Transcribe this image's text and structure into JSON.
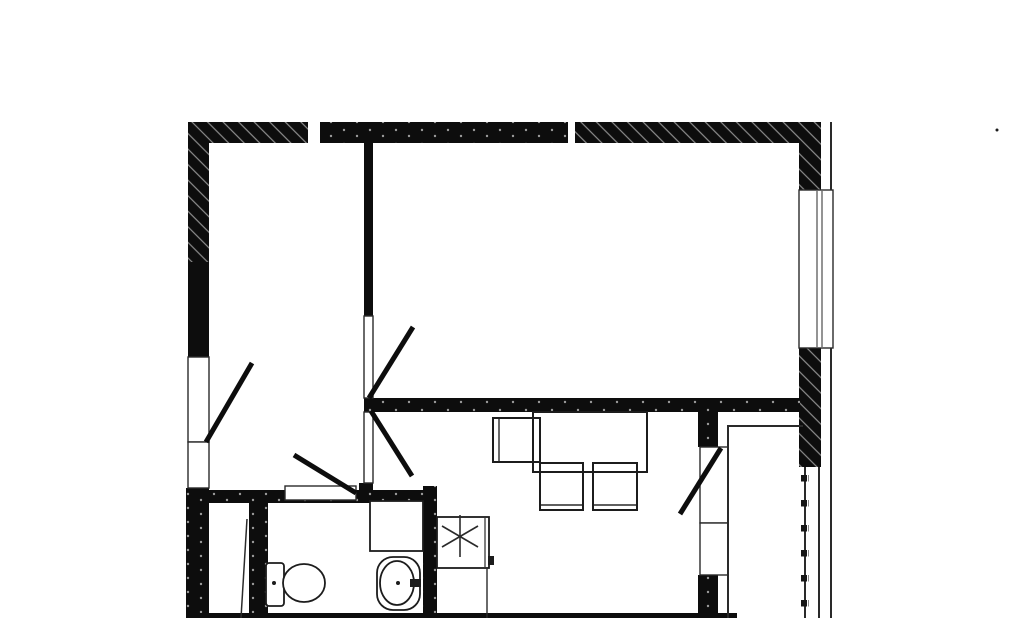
{
  "canvas": {
    "width": 1024,
    "height": 618,
    "background": "#ffffff"
  },
  "palette": {
    "wall": "#0d0d0d",
    "line": "#2a2a2a",
    "fixture": "#1c1c1c",
    "hatch_tick": "#8d8d8d",
    "dot": "#9a9a9a",
    "white": "#ffffff"
  },
  "plan": {
    "elements": [
      {
        "name": "top-wall-left-hatched",
        "kind": "rect",
        "style": "hatched",
        "x": 188,
        "y": 122,
        "w": 120,
        "h": 21
      },
      {
        "name": "top-wall-middle-dotted",
        "kind": "rect",
        "style": "dotted",
        "x": 320,
        "y": 122,
        "w": 248,
        "h": 21
      },
      {
        "name": "top-wall-right-hatched",
        "kind": "rect",
        "style": "hatched",
        "x": 575,
        "y": 122,
        "w": 246,
        "h": 21
      },
      {
        "name": "left-wall-upper",
        "kind": "rect",
        "style": "hatched",
        "x": 188,
        "y": 122,
        "w": 21,
        "h": 140
      },
      {
        "name": "left-wall-middle",
        "kind": "rect",
        "style": "solid",
        "x": 188,
        "y": 262,
        "w": 21,
        "h": 95
      },
      {
        "name": "left-wall-lower",
        "kind": "rect",
        "style": "dotted",
        "x": 186,
        "y": 488,
        "w": 23,
        "h": 130
      },
      {
        "name": "right-wall-top",
        "kind": "rect",
        "style": "hatched",
        "x": 799,
        "y": 122,
        "w": 22,
        "h": 68
      },
      {
        "name": "right-wall-between-windows",
        "kind": "rect",
        "style": "hatched",
        "x": 799,
        "y": 348,
        "w": 22,
        "h": 119
      },
      {
        "name": "right-outer-contour-line",
        "kind": "rect",
        "style": "thin",
        "x": 830,
        "y": 122,
        "w": 2,
        "h": 345
      },
      {
        "name": "interior-wall-vertical",
        "kind": "rect",
        "style": "solid",
        "x": 364,
        "y": 142,
        "w": 9,
        "h": 174
      },
      {
        "name": "interior-wall-horizontal",
        "kind": "rect",
        "style": "dotted",
        "x": 364,
        "y": 398,
        "w": 436,
        "h": 14
      },
      {
        "name": "interior-wall-junction",
        "kind": "rect",
        "style": "solid",
        "x": 359,
        "y": 483,
        "w": 14,
        "h": 20
      },
      {
        "name": "bathroom-top-wall",
        "kind": "rect",
        "style": "dotted",
        "x": 188,
        "y": 490,
        "w": 249,
        "h": 13
      },
      {
        "name": "bathroom-left-wall",
        "kind": "rect",
        "style": "dotted",
        "x": 249,
        "y": 503,
        "w": 19,
        "h": 115
      },
      {
        "name": "bathroom-right-wall",
        "kind": "rect",
        "style": "dotted",
        "x": 423,
        "y": 486,
        "w": 14,
        "h": 132
      },
      {
        "name": "balcony-wall-upper",
        "kind": "rect",
        "style": "dotted",
        "x": 698,
        "y": 412,
        "w": 20,
        "h": 35
      },
      {
        "name": "balcony-wall-lower",
        "kind": "rect",
        "style": "dotted",
        "x": 698,
        "y": 575,
        "w": 20,
        "h": 43
      },
      {
        "name": "bottom-wall-edge",
        "kind": "rect",
        "style": "solid",
        "x": 188,
        "y": 613,
        "w": 549,
        "h": 5
      },
      {
        "name": "entrance-door-opening",
        "kind": "rect",
        "style": "frame",
        "x": 188,
        "y": 357,
        "w": 21,
        "h": 85
      },
      {
        "name": "entrance-sidelight",
        "kind": "rect",
        "style": "frame",
        "x": 188,
        "y": 442,
        "w": 21,
        "h": 46
      },
      {
        "name": "room-door-opening",
        "kind": "rect",
        "style": "frame",
        "x": 364,
        "y": 316,
        "w": 9,
        "h": 82
      },
      {
        "name": "kitchen-door-opening",
        "kind": "rect",
        "style": "frame",
        "x": 364,
        "y": 412,
        "w": 9,
        "h": 71
      },
      {
        "name": "bathroom-door-threshold",
        "kind": "rect",
        "style": "frame",
        "x": 285,
        "y": 486,
        "w": 71,
        "h": 14
      },
      {
        "name": "main-window-frame",
        "kind": "rect",
        "style": "frame",
        "x": 799,
        "y": 190,
        "w": 34,
        "h": 158
      },
      {
        "name": "main-window-glass-line-1",
        "kind": "line",
        "x1": 817,
        "y1": 191,
        "x2": 817,
        "y2": 347,
        "w": 1,
        "color": "line"
      },
      {
        "name": "main-window-glass-line-2",
        "kind": "line",
        "x1": 822,
        "y1": 191,
        "x2": 822,
        "y2": 347,
        "w": 1,
        "color": "line"
      },
      {
        "name": "balcony-door-frame",
        "kind": "rect",
        "style": "frame",
        "x": 700,
        "y": 447,
        "w": 28,
        "h": 76
      },
      {
        "name": "balcony-window-frame",
        "kind": "rect",
        "style": "frame",
        "x": 700,
        "y": 523,
        "w": 28,
        "h": 52
      },
      {
        "name": "balcony-inner-edge-horizontal",
        "kind": "rect",
        "style": "thin",
        "x": 727,
        "y": 425,
        "w": 76,
        "h": 2
      },
      {
        "name": "balcony-inner-edge-vertical",
        "kind": "rect",
        "style": "thin",
        "x": 727,
        "y": 425,
        "w": 2,
        "h": 193
      },
      {
        "name": "balcony-railing-line",
        "kind": "rect",
        "style": "thin",
        "x": 804,
        "y": 467,
        "w": 2,
        "h": 151
      },
      {
        "name": "balcony-railing-beads",
        "kind": "rect",
        "style": "beads",
        "x": 801,
        "y": 472,
        "w": 8,
        "h": 146
      },
      {
        "name": "balcony-glazing-line",
        "kind": "rect",
        "style": "thin",
        "x": 818,
        "y": 467,
        "w": 2,
        "h": 151
      },
      {
        "name": "balcony-outer-line",
        "kind": "rect",
        "style": "thin",
        "x": 830,
        "y": 467,
        "w": 2,
        "h": 151
      },
      {
        "name": "entrance-door-leaf",
        "kind": "line",
        "x1": 206,
        "y1": 442,
        "x2": 252,
        "y2": 363,
        "w": 5
      },
      {
        "name": "room-door-leaf",
        "kind": "line",
        "x1": 369,
        "y1": 398,
        "x2": 413,
        "y2": 327,
        "w": 5
      },
      {
        "name": "kitchen-door-leaf",
        "kind": "line",
        "x1": 371,
        "y1": 411,
        "x2": 412,
        "y2": 476,
        "w": 5
      },
      {
        "name": "bathroom-door-leaf",
        "kind": "line",
        "x1": 356,
        "y1": 493,
        "x2": 294,
        "y2": 455,
        "w": 5
      },
      {
        "name": "balcony-door-leaf",
        "kind": "line",
        "x1": 721,
        "y1": 448,
        "x2": 680,
        "y2": 514,
        "w": 5
      },
      {
        "name": "hall-door-leaf",
        "kind": "line",
        "x1": 247,
        "y1": 519,
        "x2": 241,
        "y2": 618,
        "w": 1.5,
        "color": "line"
      },
      {
        "name": "shower-tray",
        "kind": "rect",
        "style": "fixture",
        "x": 370,
        "y": 501,
        "w": 53,
        "h": 50
      },
      {
        "name": "toilet-tank",
        "kind": "rect",
        "style": "fixture",
        "x": 266,
        "y": 563,
        "w": 18,
        "h": 43,
        "rx": 3
      },
      {
        "name": "toilet-bowl",
        "kind": "ellipse",
        "cx": 304,
        "cy": 583,
        "rx": 21,
        "ry": 19
      },
      {
        "name": "toilet-flush-dot",
        "kind": "circle",
        "cx": 274,
        "cy": 583,
        "r": 2
      },
      {
        "name": "sink-basin-outer",
        "kind": "rect",
        "style": "fixture",
        "x": 377,
        "y": 557,
        "w": 43,
        "h": 53,
        "rx": 16
      },
      {
        "name": "sink-basin-inner",
        "kind": "ellipse",
        "cx": 397,
        "cy": 583,
        "rx": 17,
        "ry": 22
      },
      {
        "name": "sink-faucet",
        "kind": "rect",
        "style": "dark",
        "x": 410,
        "y": 579,
        "w": 11,
        "h": 8
      },
      {
        "name": "sink-drain-dot",
        "kind": "circle",
        "cx": 398,
        "cy": 583,
        "r": 2
      },
      {
        "name": "kitchen-sink-box",
        "kind": "rect",
        "style": "fixture",
        "x": 437,
        "y": 517,
        "w": 52,
        "h": 51
      },
      {
        "name": "kitchen-sink-edge-line",
        "kind": "line",
        "x1": 485,
        "y1": 518,
        "x2": 485,
        "y2": 567,
        "w": 1.2,
        "color": "line"
      },
      {
        "name": "kitchen-sink-tab",
        "kind": "rect",
        "style": "dark",
        "x": 488,
        "y": 556,
        "w": 6,
        "h": 9
      },
      {
        "name": "kitchen-sink-symbol-vertical",
        "kind": "line",
        "x1": 460,
        "y1": 515,
        "x2": 460,
        "y2": 557,
        "w": 1.6,
        "color": "line"
      },
      {
        "name": "kitchen-sink-symbol-diag-1",
        "kind": "line",
        "x1": 442,
        "y1": 526,
        "x2": 478,
        "y2": 547,
        "w": 1.6,
        "color": "line"
      },
      {
        "name": "kitchen-sink-symbol-diag-2",
        "kind": "line",
        "x1": 478,
        "y1": 526,
        "x2": 442,
        "y2": 547,
        "w": 1.6,
        "color": "line"
      },
      {
        "name": "kitchen-counter-edge",
        "kind": "line",
        "x1": 487,
        "y1": 568,
        "x2": 487,
        "y2": 618,
        "w": 1.4,
        "color": "line"
      },
      {
        "name": "dining-table",
        "kind": "rect",
        "style": "outline",
        "x": 533,
        "y": 412,
        "w": 114,
        "h": 60
      },
      {
        "name": "chair-left",
        "kind": "rect",
        "style": "outline",
        "x": 493,
        "y": 418,
        "w": 47,
        "h": 44
      },
      {
        "name": "chair-left-backrest",
        "kind": "line",
        "x1": 499,
        "y1": 419,
        "x2": 499,
        "y2": 461,
        "w": 1.4,
        "color": "line"
      },
      {
        "name": "chair-bottom-1",
        "kind": "rect",
        "style": "outline",
        "x": 540,
        "y": 463,
        "w": 43,
        "h": 47
      },
      {
        "name": "chair-bottom-1-backrest",
        "kind": "line",
        "x1": 541,
        "y1": 505,
        "x2": 582,
        "y2": 505,
        "w": 1.4,
        "color": "line"
      },
      {
        "name": "chair-bottom-2",
        "kind": "rect",
        "style": "outline",
        "x": 593,
        "y": 463,
        "w": 44,
        "h": 47
      },
      {
        "name": "chair-bottom-2-backrest",
        "kind": "line",
        "x1": 594,
        "y1": 505,
        "x2": 636,
        "y2": 505,
        "w": 1.4,
        "color": "line"
      },
      {
        "name": "speck-artifact",
        "kind": "circle",
        "cx": 997,
        "cy": 130,
        "r": 1.5
      }
    ]
  }
}
